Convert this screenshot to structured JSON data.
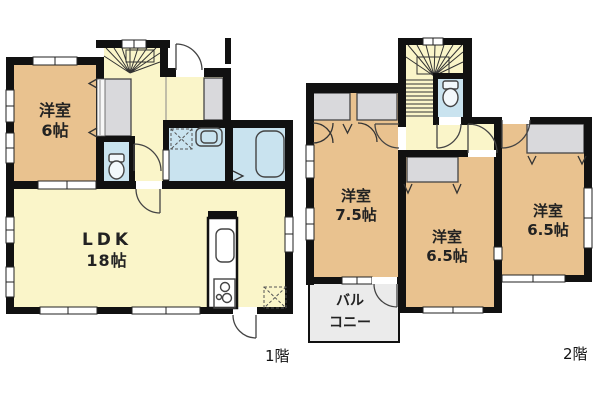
{
  "floor1": {
    "floor_label": "1階",
    "rooms": {
      "west6": {
        "name": "洋室",
        "size": "6帖"
      },
      "ldk": {
        "name": "LDK",
        "size": "18帖"
      }
    }
  },
  "floor2": {
    "floor_label": "2階",
    "rooms": {
      "west75": {
        "name": "洋室",
        "size": "7.5帖"
      },
      "west65a": {
        "name": "洋室",
        "size": "6.5帖"
      },
      "west65b": {
        "name": "洋室",
        "size": "6.5帖"
      },
      "balcony": {
        "name_line1": "バル",
        "name_line2": "コニー"
      }
    }
  },
  "colors": {
    "wall": "#111111",
    "room_tan": "#e9c28f",
    "floor_yellow": "#faf5c9",
    "wet_blue": "#c9e3ef",
    "closet_gray": "#d9d9dc",
    "balcony_gray": "#ebebeb"
  }
}
